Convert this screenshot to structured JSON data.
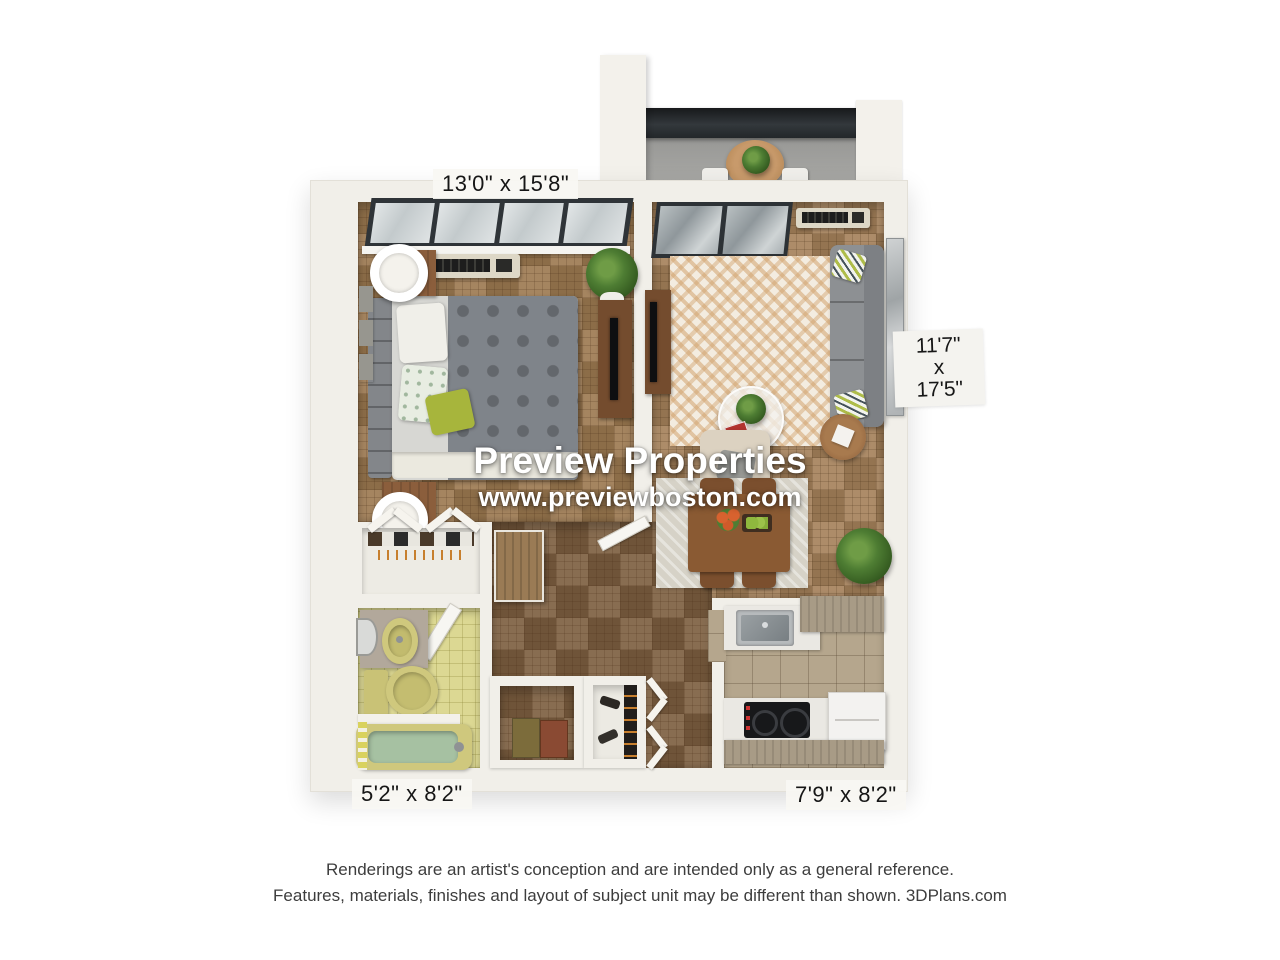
{
  "watermark": {
    "brand": "Preview Properties",
    "website": "www.previewboston.com"
  },
  "room_dimensions": {
    "bedroom": "13'0\" x 15'8\"",
    "living_room": [
      "11'7\"",
      "x",
      "17'5\""
    ],
    "bathroom": "5'2\" x 8'2\"",
    "kitchen": "7'9\" x 8'2\""
  },
  "disclaimer": {
    "line1": "Renderings are an artist's conception and are intended only as a general reference.",
    "line2": "Features, materials, finishes and layout of subject unit may be different than shown. 3DPlans.com"
  },
  "colors": {
    "wall_white": "#f1efe9",
    "parquet_wood": "#9c7950",
    "hall_wood_dark": "#7c5e40",
    "bath_tile_yellow": "#dcd893",
    "bath_fixture_yellow": "#cfc87d",
    "tub_water_green": "#a6c1a2",
    "kitchen_tile_tan": "#b5a68d",
    "sofa_gray": "#8d9093",
    "rug_cream": "#f3ece0",
    "furniture_wood": "#8b5e3c",
    "balcony_concrete": "#a0a09e",
    "railing_dark": "#2c3034",
    "plant_green": "#4e7d33"
  }
}
